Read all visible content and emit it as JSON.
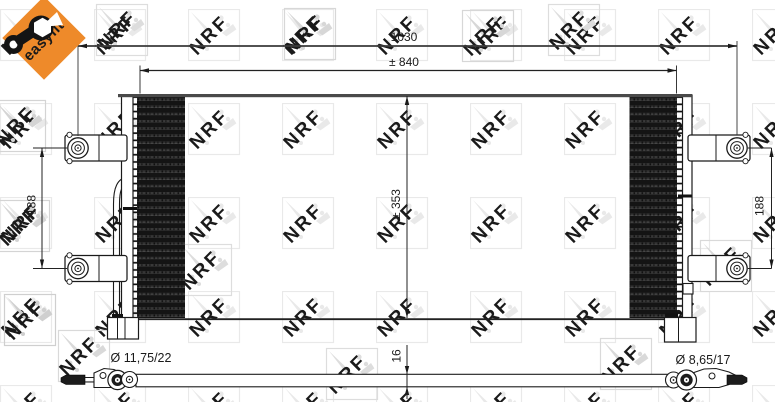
{
  "badge": {
    "label": "easyfit"
  },
  "watermark": {
    "text": "NRF"
  },
  "dimensions": {
    "overall_width": "1030",
    "core_width": "± 840",
    "core_height": "± 353",
    "left_mount_pitch": "188",
    "right_mount_pitch": "188",
    "profile_thickness": "16",
    "left_connection": "Ø 11,75/22",
    "right_connection": "Ø 8,65/17"
  },
  "colors": {
    "badge_orange": "#EE8A2A",
    "line": "#1a1a1a",
    "core_fill": "#161616",
    "top_bar": "#4a4a4a",
    "watermark": "#e9e9e9",
    "watermark_accent": "#d4d4d4"
  }
}
